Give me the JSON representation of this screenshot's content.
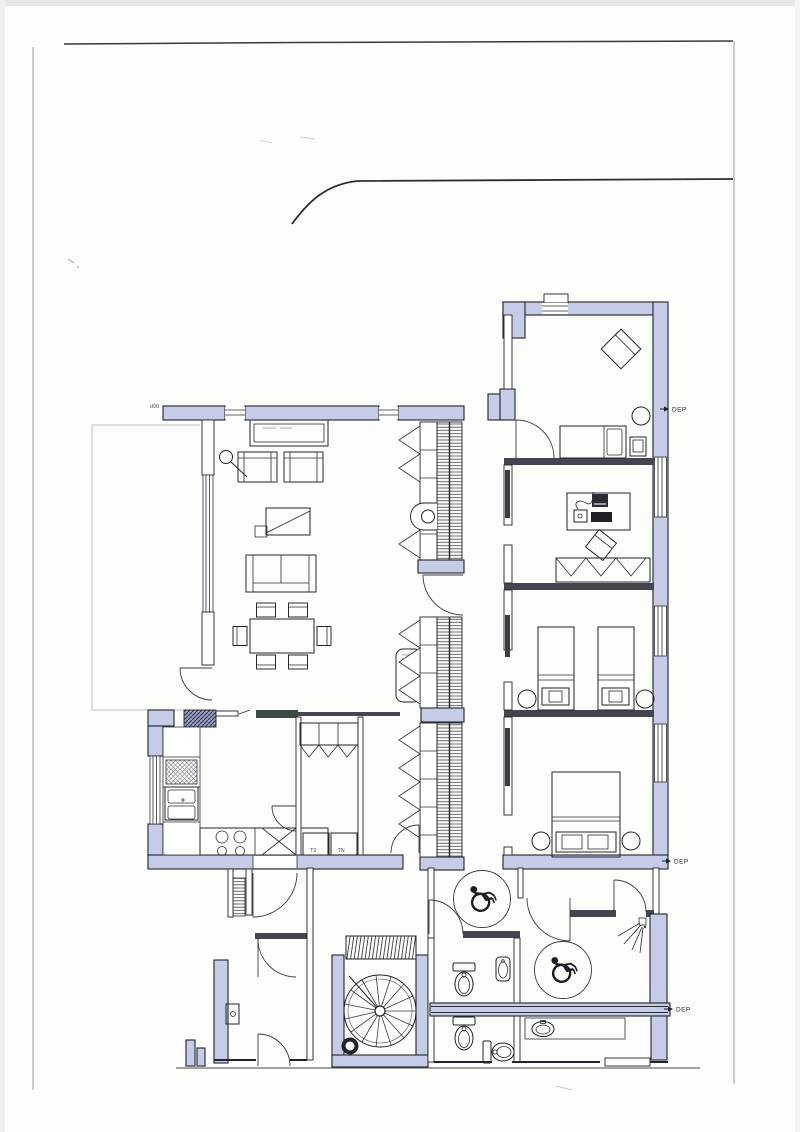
{
  "document": {
    "title": "Scanned architectural floor plan",
    "type": "floor-plan-scan"
  },
  "labels": {
    "dep_top": "DEP",
    "dep_middle": "DEP",
    "dep_bottom": "DEP",
    "door_width_note": "d90",
    "utility_unit_left": "TS",
    "utility_unit_right": "TN"
  },
  "colors": {
    "paper": "#fdfdfb",
    "scan_edge": "#e7e7e3",
    "wall_fill": "#c6cce8",
    "wall_fill_shaded": "#9aa0c4",
    "line_dark": "#23232b",
    "partition_dark": "#45454f",
    "cabinet_dark": "#3e4a44",
    "boundary_line": "#3a3a34"
  },
  "icons": [
    "wheelchair-icon",
    "spiral-staircase-icon",
    "straight-stair-icon",
    "toilet-icon",
    "washbasin-icon",
    "shower-icon",
    "cooktop-icon",
    "kitchen-sink-icon",
    "floor-lamp-icon",
    "bed-icon",
    "double-bed-icon",
    "sofa-icon",
    "armchair-icon",
    "dining-table-icon",
    "desk-computer-icon",
    "wardrobe-hatch-icon",
    "door-swing-icon",
    "dep-arrow-icon"
  ]
}
